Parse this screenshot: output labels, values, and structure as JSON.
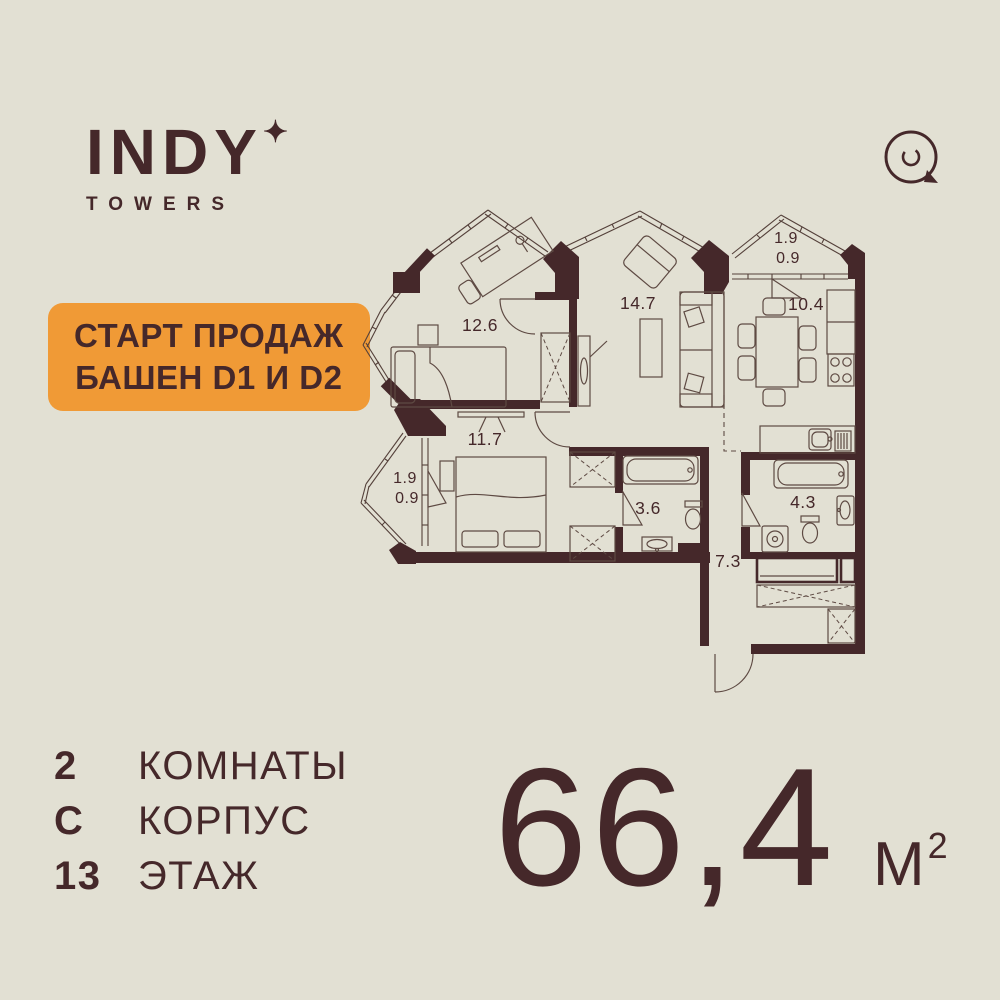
{
  "colors": {
    "background": "#e2e0d3",
    "ink": "#45282a",
    "accent": "#f09a36"
  },
  "brand": {
    "name": "INDY",
    "star": "✦",
    "subtitle": "TOWERS"
  },
  "badge": {
    "line1": "СТАРТ ПРОДАЖ",
    "line2": "БАШЕН D1 И D2"
  },
  "plan": {
    "rooms": {
      "bedroom2": "12.6",
      "living": "14.7",
      "kitchen": "10.4",
      "bedroom1": "11.7",
      "bathroom1": "3.6",
      "bathroom2": "4.3",
      "hallway": "7.3"
    },
    "balcony_kitchen": {
      "total": "1.9",
      "reduced": "0.9"
    },
    "balcony_bedroom": {
      "total": "1.9",
      "reduced": "0.9"
    }
  },
  "specs": {
    "rooms": {
      "value": "2",
      "label": "КОМНАТЫ"
    },
    "building": {
      "value": "С",
      "label": "КОРПУС"
    },
    "floor": {
      "value": "13",
      "label": "ЭТАЖ"
    }
  },
  "area": {
    "value": "66,4",
    "unit": "М",
    "sup": "2"
  }
}
